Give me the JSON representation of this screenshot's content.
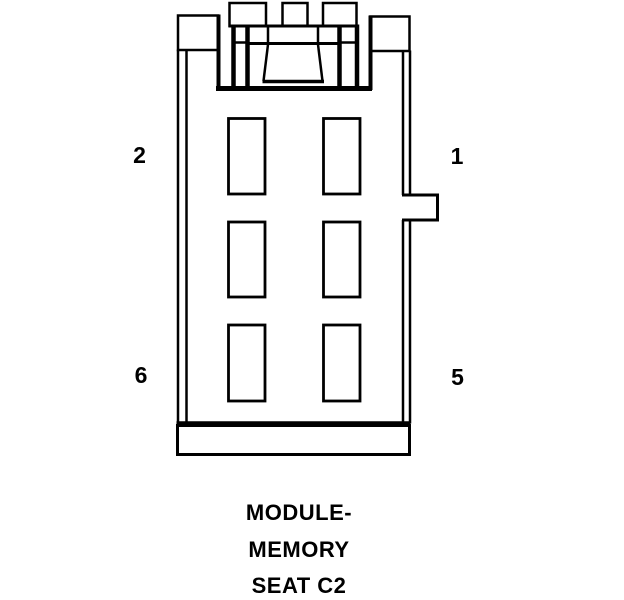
{
  "diagram": {
    "kind": "connector-pinout",
    "pin_count": 6,
    "pin_labels": {
      "top_left": "2",
      "top_right": "1",
      "bottom_left": "6",
      "bottom_right": "5"
    },
    "caption": {
      "line1": "MODULE-",
      "line2": "MEMORY",
      "line3": "SEAT C2"
    },
    "colors": {
      "line": "#000000",
      "background": "#ffffff"
    }
  }
}
